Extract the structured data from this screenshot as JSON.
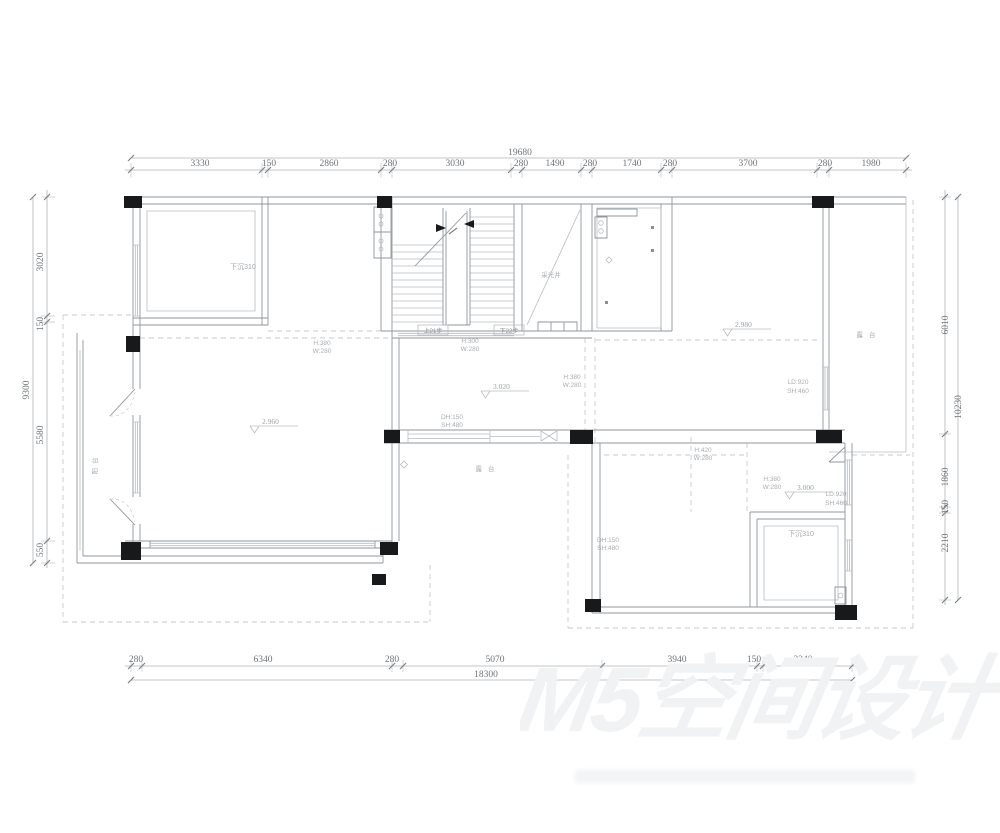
{
  "meta": {
    "background": "#ffffff",
    "line_color": "#90979b",
    "dim_text_color": "#6f7478",
    "dashed_color": "#c6cacd",
    "column_color": "#17191b",
    "label_color": "#a8adb1",
    "watermark_color": "#f0f2f3"
  },
  "dimensions": {
    "top": {
      "total": "19680",
      "segments": [
        "3330",
        "150",
        "2860",
        "280",
        "3030",
        "280",
        "1490",
        "280",
        "1740",
        "280",
        "3700",
        "280",
        "1980"
      ]
    },
    "bottom": {
      "total": "18300",
      "segments": [
        "280",
        "6340",
        "280",
        "5070",
        "3940",
        "150",
        "2240"
      ]
    },
    "left": {
      "total": "9300",
      "segments": [
        "3020",
        "150",
        "5580",
        "550"
      ]
    },
    "right": {
      "total": "10230",
      "segments": [
        "6010",
        "1860",
        "150",
        "2210"
      ]
    }
  },
  "labels": {
    "stair_up": "上21步",
    "stair_down": "下22步",
    "light_well": "采光井",
    "balcony": "阳台",
    "terrace_right": "露台",
    "terrace_mid": "露台",
    "platform_tl": "下沉310",
    "platform_br": "下沉310"
  },
  "specs": {
    "win_left": {
      "l1": "H:380",
      "l2": "W:280"
    },
    "win_stair": {
      "l1": "H:300",
      "l2": "W:280"
    },
    "win_mid": {
      "l1": "H:380",
      "l2": "W:280"
    },
    "win_h420": {
      "l1": "H:420",
      "l2": "W:280"
    },
    "win_br": {
      "l1": "H:380",
      "l2": "W:280"
    },
    "dh_center": {
      "l1": "DH:150",
      "l2": "SH:480"
    },
    "dh_br": {
      "l1": "DH:150",
      "l2": "SH:480"
    },
    "ld_right": {
      "l1": "LD:920",
      "l2": "SH:460"
    },
    "ld_br": {
      "l1": "LD:920",
      "l2": "SH:460"
    }
  },
  "levels": {
    "left_room": "2.960",
    "hall": "3.020",
    "right_room": "2.980",
    "br_room": "3.000"
  },
  "watermark": {
    "text": "M5空间设计"
  }
}
